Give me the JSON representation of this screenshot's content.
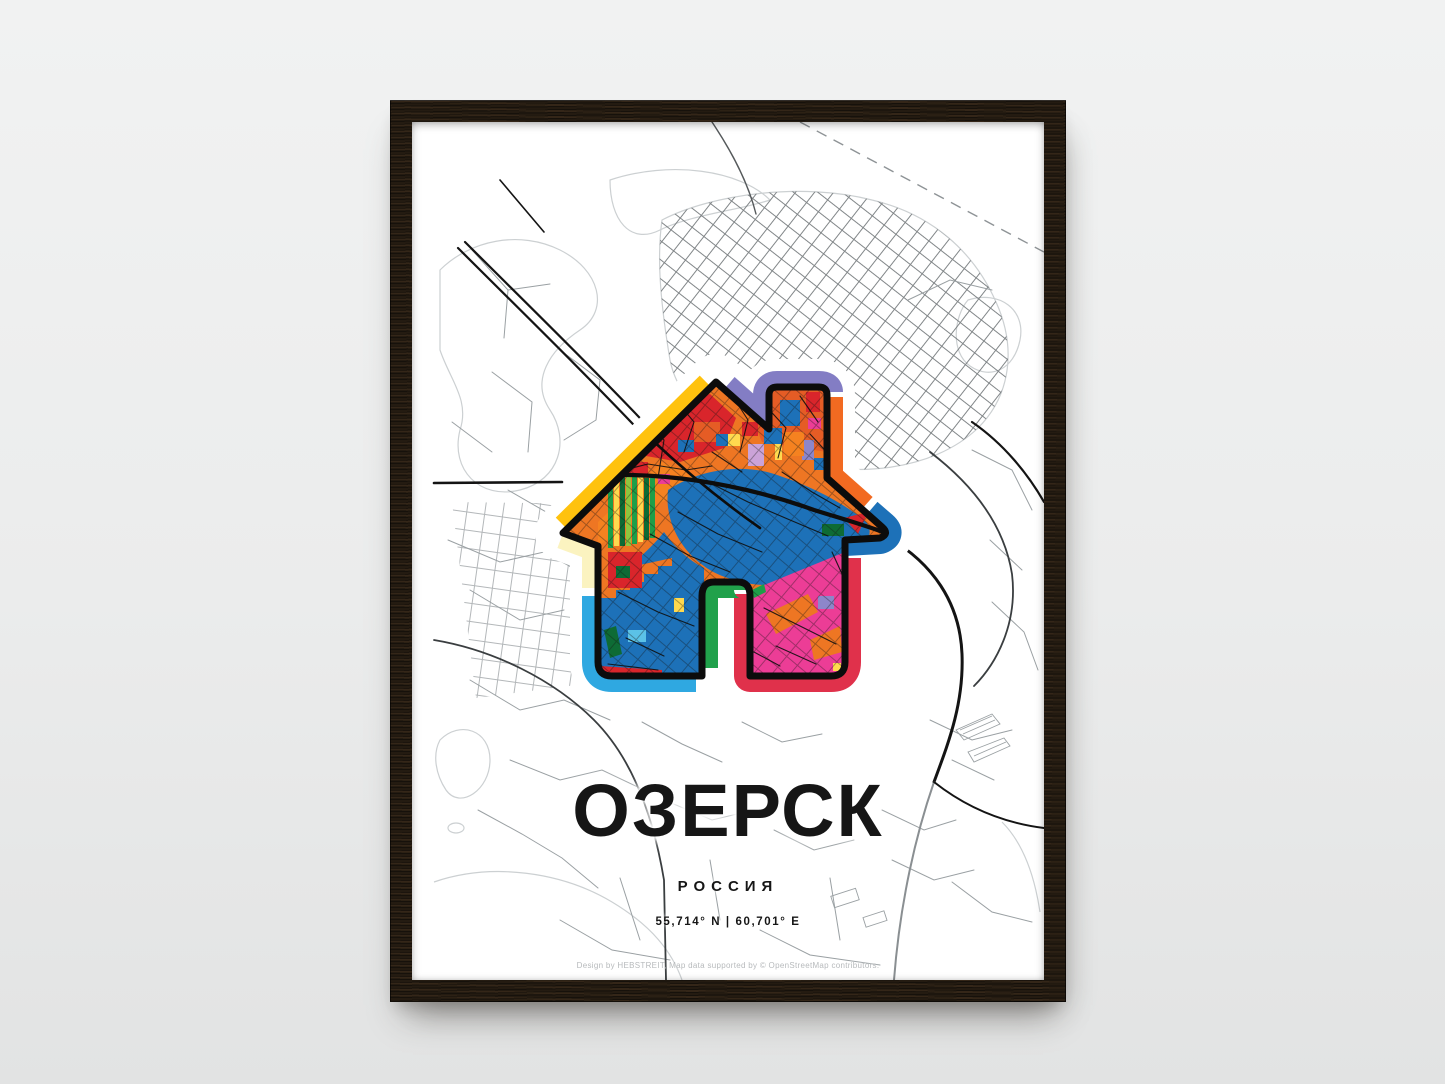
{
  "scene": {
    "wall_color": "#ebecec",
    "frame_color": "#241b11"
  },
  "poster": {
    "title": "ОЗЕРСК",
    "subtitle": "РОССИЯ",
    "coordinates": "55,714° N | 60,701° E",
    "credit": "Design by HEBSTREIT, Map data supported by © OpenStreetMap contributors.",
    "map_colors": {
      "background": "#ffffff",
      "street_light": "#ccd0d2",
      "street_mid": "#9aa0a3",
      "street_dense": "#73787b",
      "road_black": "#141414"
    },
    "home_icon": {
      "name": "home-icon",
      "outline_color": "#0c0c0c",
      "halo_color": "#ffffff",
      "ring": [
        {
          "name": "roof-left",
          "color": "#ffc20e"
        },
        {
          "name": "chimney-top",
          "color": "#837dc4"
        },
        {
          "name": "chimney-right",
          "color": "#f26a21"
        },
        {
          "name": "eave-right",
          "color": "#1d71b8"
        },
        {
          "name": "wall-right-bottom",
          "color": "#e0314b"
        },
        {
          "name": "door",
          "color": "#21a14b"
        },
        {
          "name": "wall-left-bottom",
          "color": "#2fa8e1"
        },
        {
          "name": "wall-left-top",
          "color": "#fbf3c0"
        }
      ],
      "fill_palette": {
        "orange": "#ee7623",
        "orange_dark": "#e55c25",
        "orange_bright": "#f58220",
        "lake_blue": "#1d71b8",
        "red": "#d9252b",
        "pink": "#ec3d96",
        "yellow": "#ffd94f",
        "green": "#1e9e48",
        "green_dark": "#0e6b35",
        "lime": "#8cc63f",
        "purple": "#8d86ca",
        "lavender": "#cba3d8",
        "sky": "#5bc2e7"
      }
    }
  }
}
